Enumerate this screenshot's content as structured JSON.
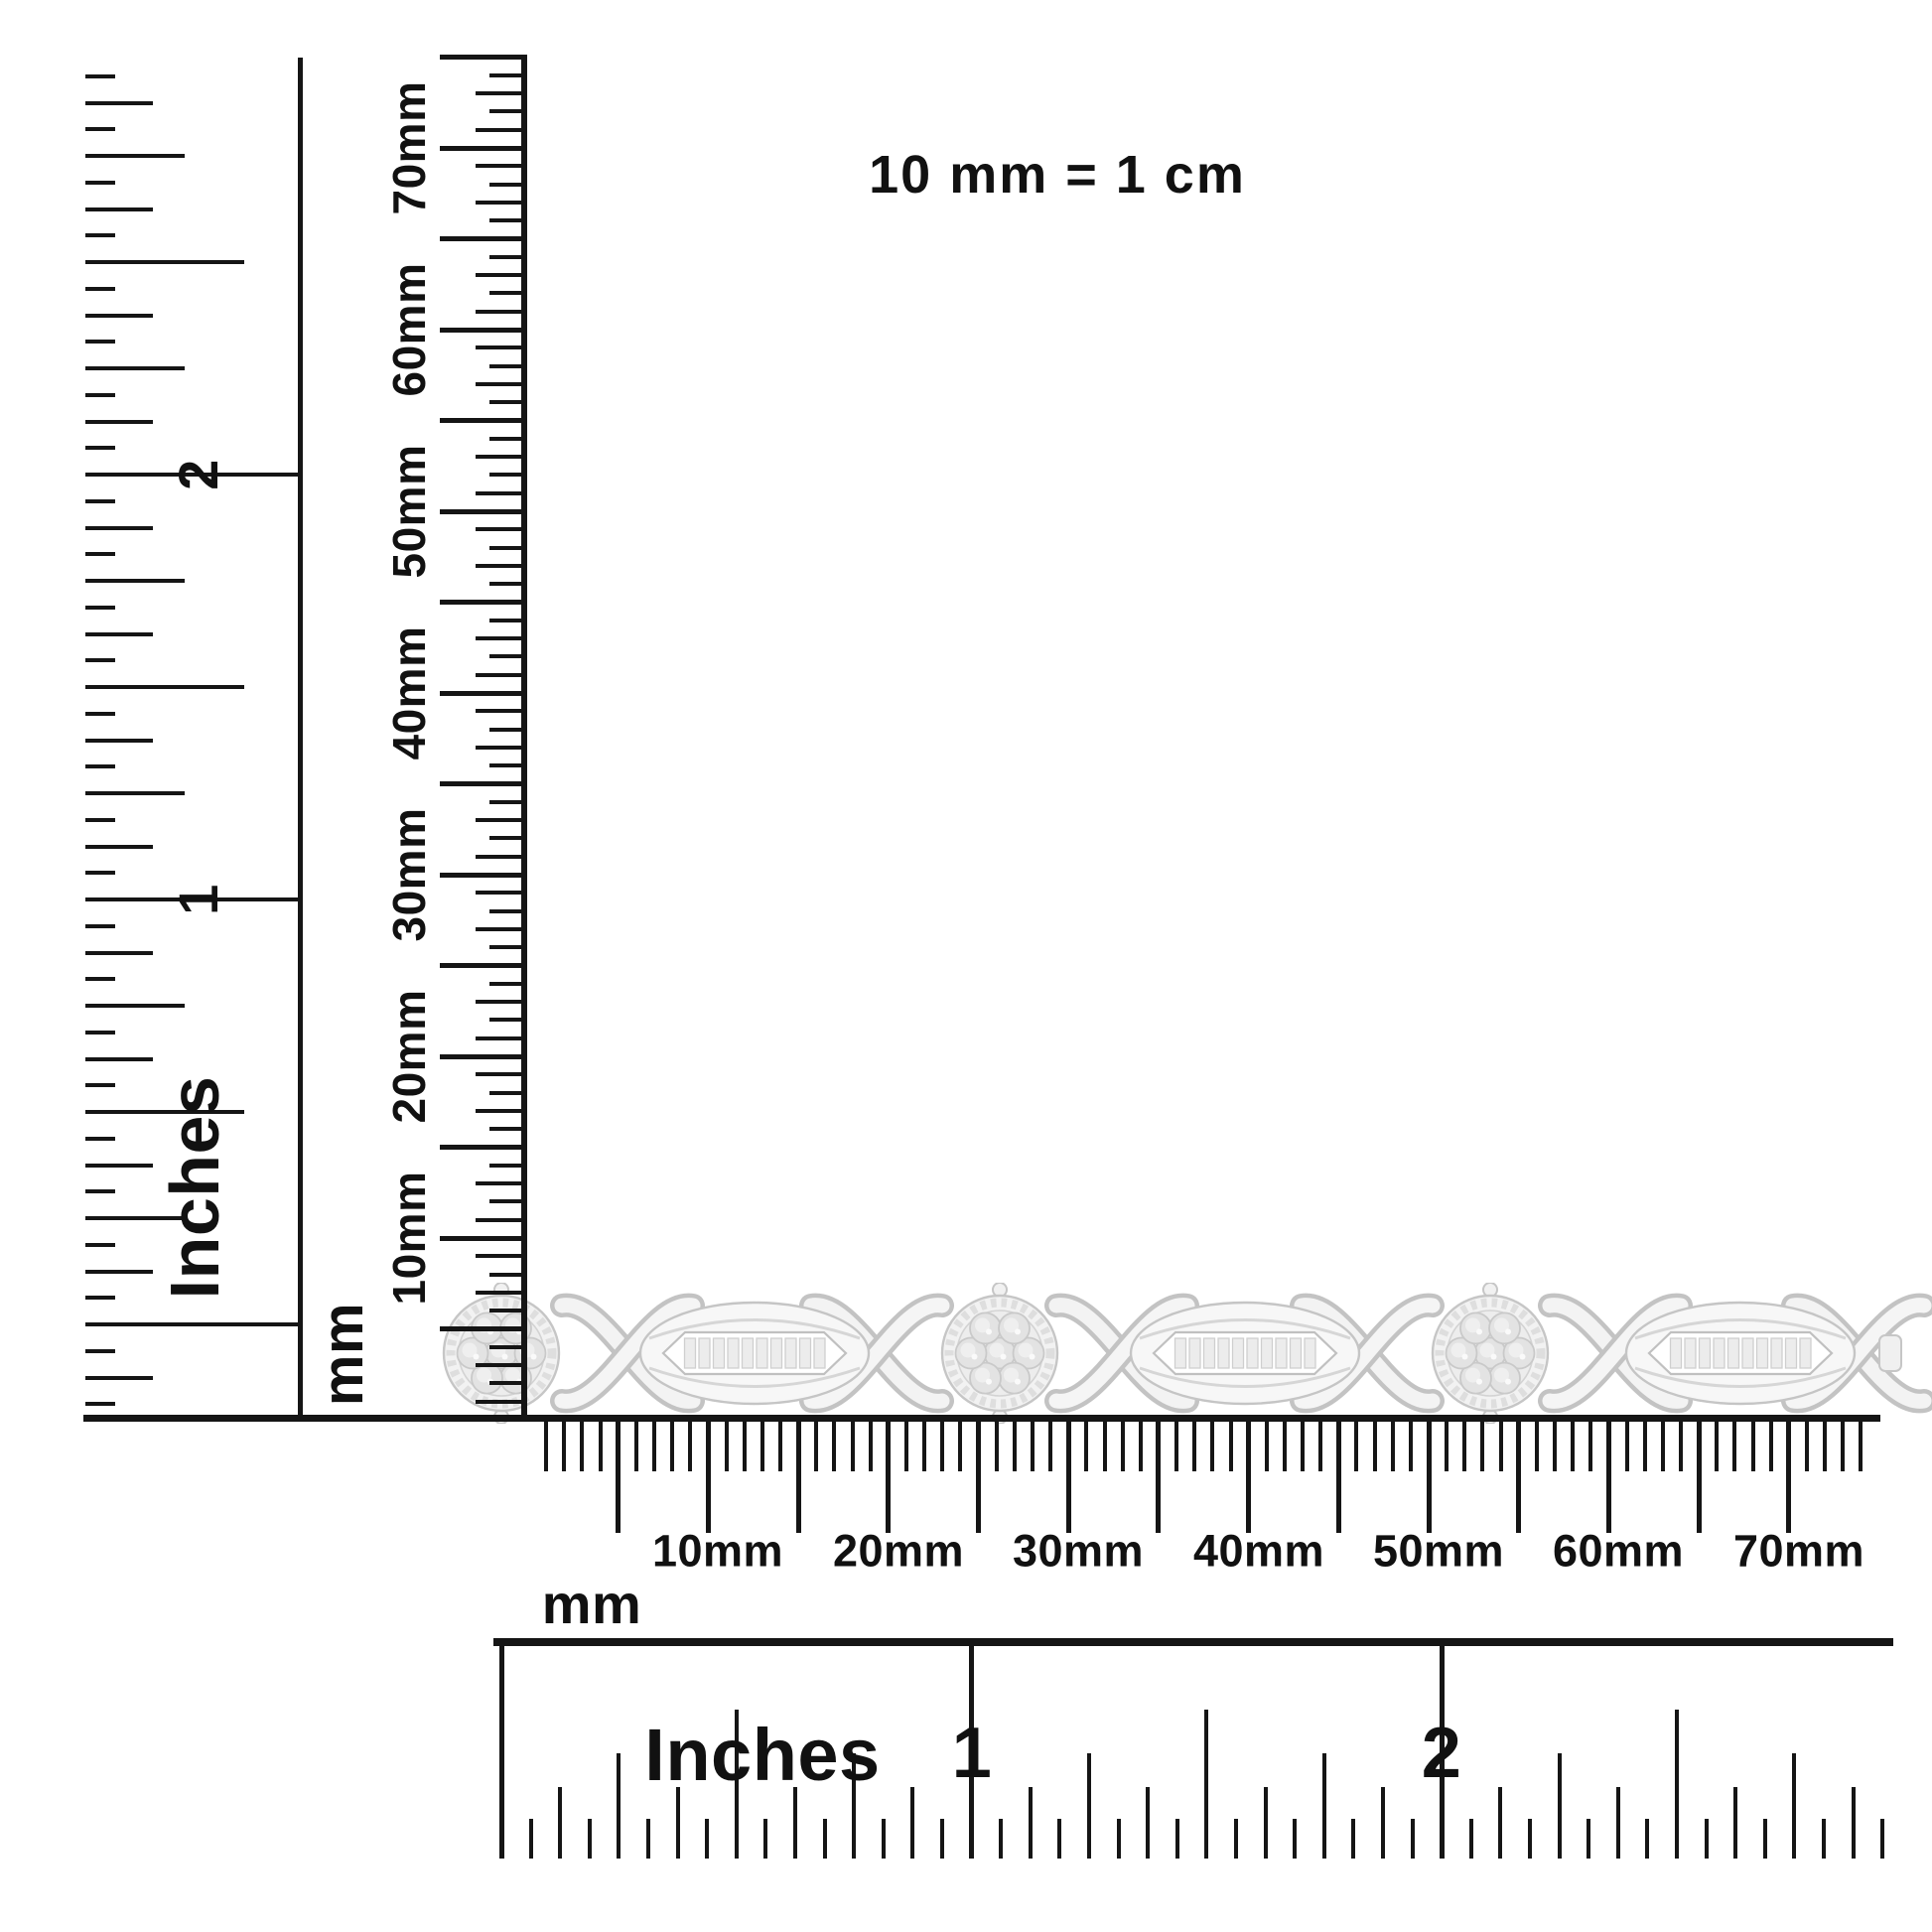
{
  "scale_note": "10 mm = 1 cm",
  "rulers": {
    "left_inch": {
      "unit_label": "Inches",
      "numbers": [
        "1",
        "2"
      ]
    },
    "left_mm": {
      "unit_label": "mm",
      "tick_labels": [
        "70mm",
        "60mm",
        "50mm",
        "40mm",
        "30mm",
        "20mm",
        "10mm"
      ]
    },
    "bottom_mm": {
      "unit_label": "mm",
      "tick_labels": [
        "10mm",
        "20mm",
        "30mm",
        "40mm",
        "50mm",
        "60mm",
        "70mm"
      ]
    },
    "bottom_inch": {
      "unit_label": "Inches",
      "numbers": [
        "1",
        "2"
      ]
    }
  },
  "colors": {
    "ink": "#151515",
    "background": "#ffffff",
    "metal_light": "#f4f4f4",
    "metal_mid": "#e4e4e4",
    "metal_outline": "#c6c6c6"
  }
}
